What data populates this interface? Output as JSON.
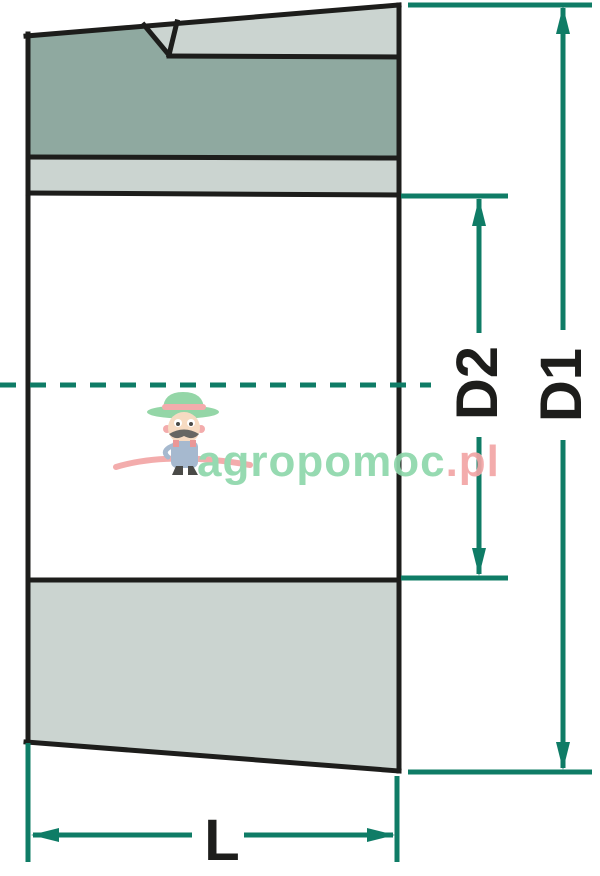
{
  "diagram": {
    "labels": {
      "d1": "D1",
      "d2": "D2",
      "length": "L"
    }
  },
  "watermark": {
    "brand": "agropomoc",
    "tld": ".pl"
  },
  "colors": {
    "dimension": "#0F7C66",
    "outline": "#1D1D1B",
    "fill_dark": "#8FA9A0",
    "fill_light": "#CBD4D0",
    "bore": "#FFFFFF",
    "watermark_green": "#8ED7AB",
    "watermark_pink": "#F2A6A6",
    "background": "#FFFFFF"
  }
}
